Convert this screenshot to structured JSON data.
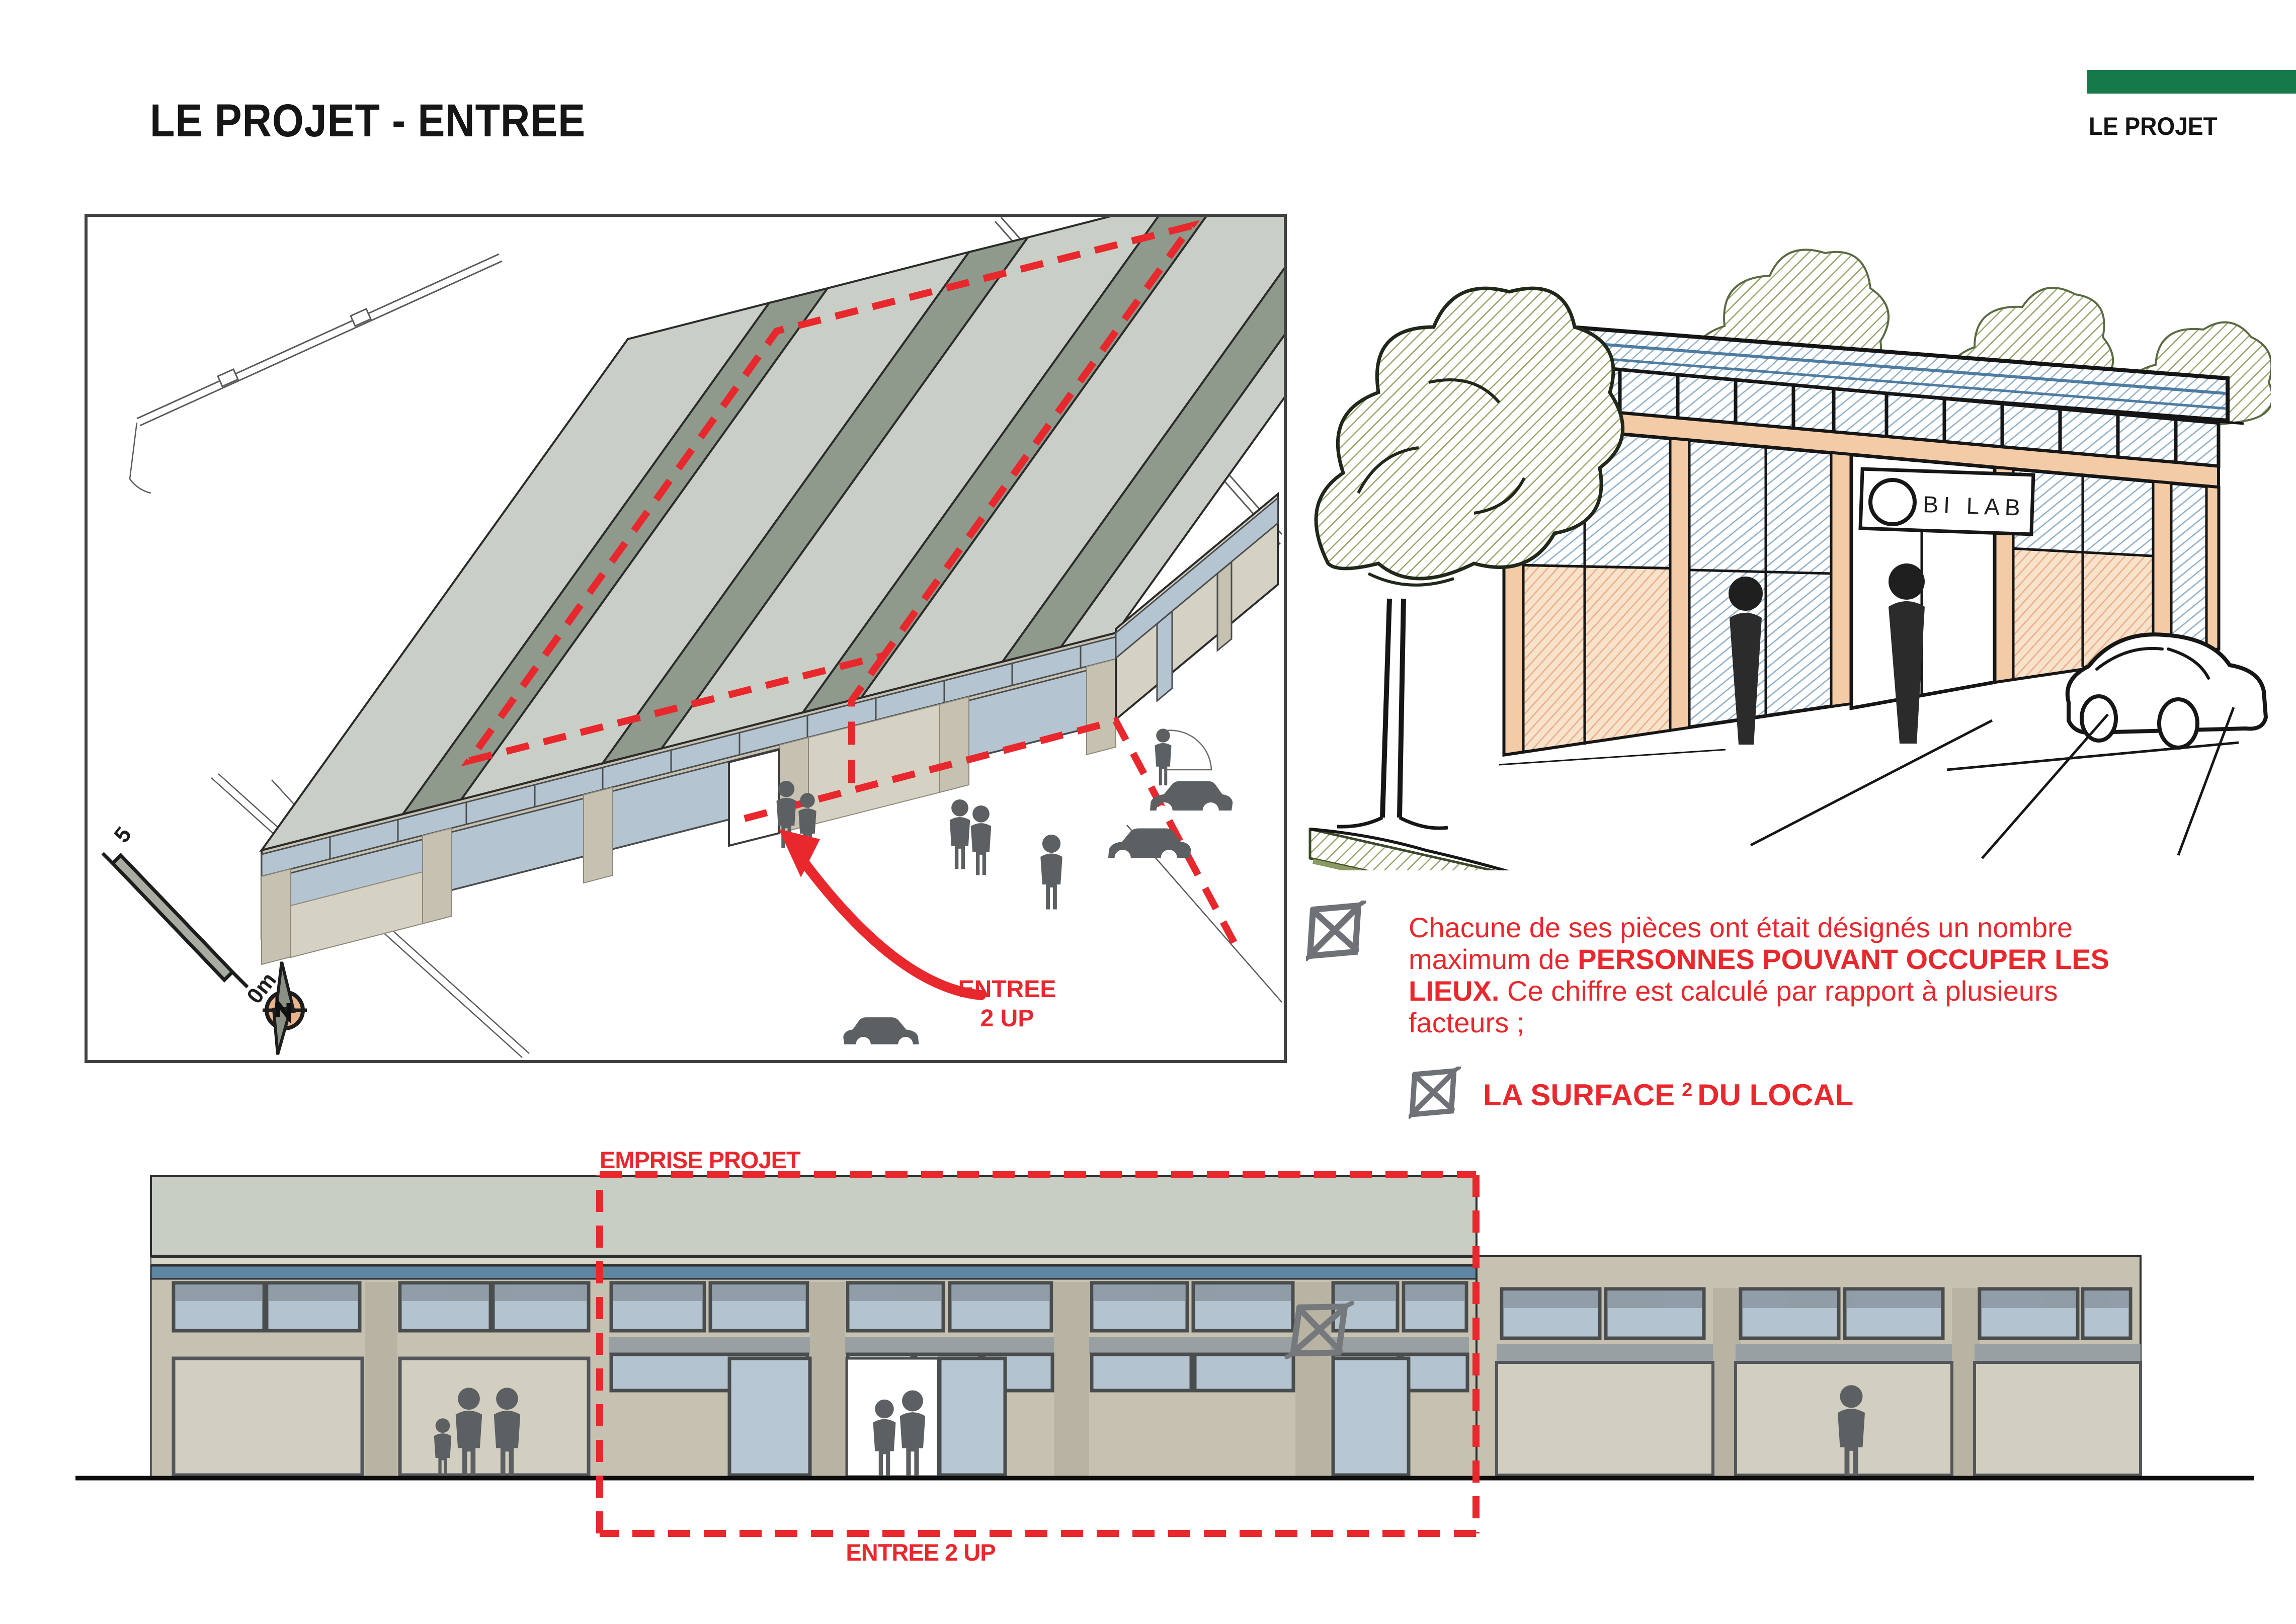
{
  "header": {
    "title": "LE PROJET - ENTREE",
    "corner_label": "LE PROJET"
  },
  "axon": {
    "entree_line1": "ENTREE",
    "entree_line2": "2 UP",
    "scale_start": "5",
    "scale_end": "0m"
  },
  "sketch": {
    "sign_text": "BI LAB"
  },
  "notes": {
    "para_1": "Chacune de ses pièces ont était désignés un nombre maximum de ",
    "para_2_bold": "PERSONNES POUVANT OCCUPER LES LIEUX.",
    "para_3": " Ce chiffre est calculé par rapport à plusieurs facteurs ;",
    "item_pre": "LA SURFACE",
    "item_sup": "2",
    "item_post": "DU LOCAL"
  },
  "elevation": {
    "emprise_label": "EMPRISE PROJET",
    "entree_label": "ENTREE 2 UP"
  },
  "colors": {
    "accent_red": "#E8282D",
    "brand_green": "#15794A",
    "roof_band": "#C8CEC4",
    "roof_band_dark": "#8F998C",
    "blue_band": "#5E85A1",
    "glass": "#B4C3D0",
    "wall_beige": "#C6C1B1",
    "figure_gray": "#5C6063"
  }
}
